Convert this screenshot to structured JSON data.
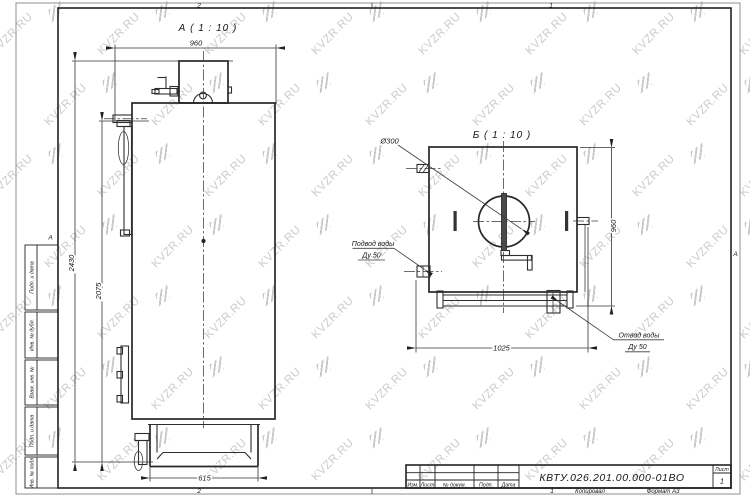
{
  "watermark": {
    "text": "KVZR.RU"
  },
  "sheet": {
    "zones": {
      "top_left": "2",
      "top_right": "1",
      "bottom_left": "2",
      "bottom_right": "1",
      "left": "А",
      "right": "А"
    },
    "margin_fields": {
      "f1": "Подп. и дата",
      "f2": "Инв. № дубл.",
      "f3": "Взам. инв. №",
      "f4": "Подп. и дата",
      "f5": "Инв. № подл."
    },
    "footer": {
      "copied": "Копировал",
      "format": "Формат А3"
    }
  },
  "title_block": {
    "doc_number": "КВТУ.026.201.00.000-01ВО",
    "col_izm": "Изм.",
    "col_list": "Лист",
    "col_doc": "№ докум.",
    "col_podp": "Подп.",
    "col_data": "Дата",
    "sheet_label": "Лист",
    "sheet_number": "1"
  },
  "view_a": {
    "title": "А ( 1 : 10 )",
    "dim_width": "960",
    "dim_height_total": "2430",
    "dim_height_body": "2075",
    "dim_base": "615"
  },
  "view_b": {
    "title": "Б ( 1 : 10 )",
    "dim_height": "960",
    "dim_width": "1025",
    "dim_diameter": "Ø300",
    "label_inlet_1": "Подвод воды",
    "label_inlet_2": "Ду 50",
    "label_outlet_1": "Отвод воды",
    "label_outlet_2": "Ду 50"
  }
}
